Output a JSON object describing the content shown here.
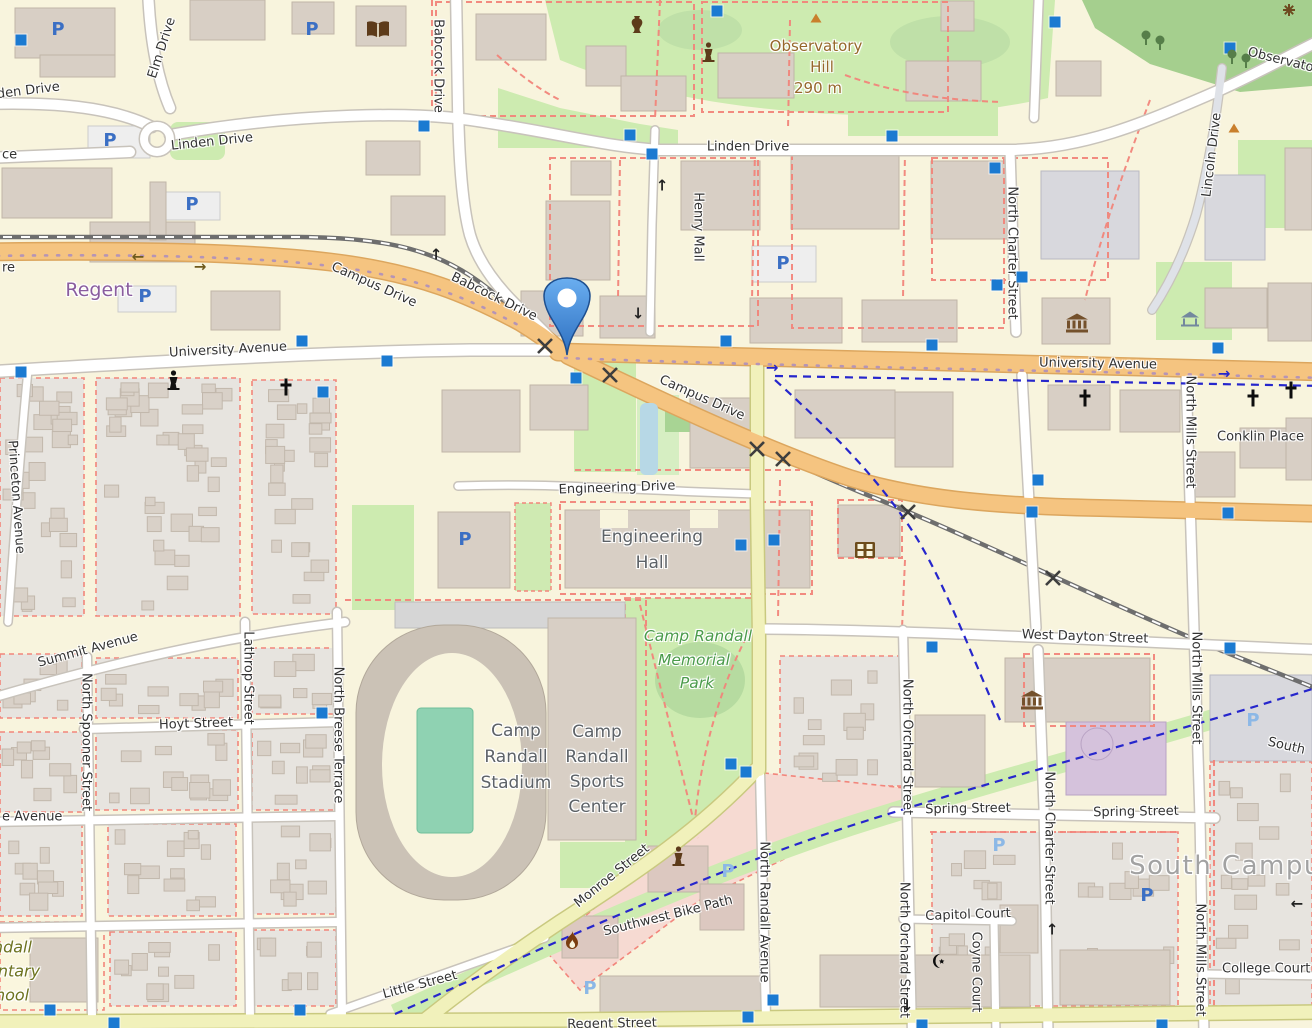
{
  "map": {
    "style": "openstreetmap-carto",
    "colors": {
      "campus_land": "#f8f4dd",
      "residential": "#e7e4df",
      "building": "#d8cfc5",
      "building_stroke": "#c0b5a8",
      "park_green": "#cdebb0",
      "wood_green": "#a5cf8e",
      "field_teal": "#8fd2b2",
      "road_orange": "#f5c480",
      "road_yellow": "#f1f1bb",
      "road_white": "#ffffff",
      "railway": "#6e6e6e",
      "footpath_red": "#f2857b",
      "cycleway_blue": "#2626cc",
      "parking_blue": "#3b6fc4",
      "parking_private": "#8cb8e6",
      "transit_square": "#1b7ad1",
      "water": "#b7d8e6",
      "pin_blue": "#3a7fd0",
      "retail_pink": "#f6dad2",
      "theatre_purple": "#d5c2dc"
    },
    "marker": {
      "x": 567,
      "y": 355,
      "shape": "teardrop-pin",
      "color": "#3a7fd0"
    },
    "labels": [
      {
        "t": "Elm Drive",
        "x": 162,
        "y": 48,
        "r": -72
      },
      {
        "t": "Linden Drive",
        "x": -22,
        "y": 97,
        "r": -7,
        "a": "start"
      },
      {
        "t": "Linden Drive",
        "x": 212,
        "y": 142,
        "r": -6
      },
      {
        "t": "Linden Drive",
        "x": 748,
        "y": 147,
        "r": 0
      },
      {
        "t": "Babcock Drive",
        "x": 438,
        "y": 66,
        "r": 90
      },
      {
        "t": "Babcock Drive",
        "x": 494,
        "y": 297,
        "r": 26
      },
      {
        "t": "Campus Drive",
        "x": 374,
        "y": 285,
        "r": 24
      },
      {
        "t": "Campus Drive",
        "x": 702,
        "y": 398,
        "r": 24
      },
      {
        "t": "Regent",
        "x": 99,
        "y": 290,
        "r": 0,
        "cls": "suburb"
      },
      {
        "t": "University Avenue",
        "x": 228,
        "y": 350,
        "r": -3
      },
      {
        "t": "University Avenue",
        "x": 1098,
        "y": 364,
        "r": 1
      },
      {
        "t": "Henry Mall",
        "x": 698,
        "y": 227,
        "r": 90
      },
      {
        "t": "Observatory",
        "x": 816,
        "y": 46,
        "r": 0,
        "cls": "peak"
      },
      {
        "t": "Hill",
        "x": 822,
        "y": 67,
        "r": 0,
        "cls": "peak"
      },
      {
        "t": "290 m",
        "x": 818,
        "y": 88,
        "r": 0,
        "cls": "peak"
      },
      {
        "t": "North Charter Street",
        "x": 1012,
        "y": 253,
        "r": 90
      },
      {
        "t": "Lincoln Drive",
        "x": 1212,
        "y": 155,
        "r": -83
      },
      {
        "t": "Observatory Drive",
        "x": 1248,
        "y": 52,
        "r": 14,
        "a": "start"
      },
      {
        "t": "Conklin Place",
        "x": 1217,
        "y": 437,
        "r": 0,
        "a": "start"
      },
      {
        "t": "Engineering Drive",
        "x": 617,
        "y": 488,
        "r": -2
      },
      {
        "t": "Engineering",
        "x": 652,
        "y": 537,
        "cls": "building"
      },
      {
        "t": "Hall",
        "x": 652,
        "y": 563,
        "cls": "building"
      },
      {
        "t": "Camp Randall",
        "x": 698,
        "y": 636,
        "cls": "park"
      },
      {
        "t": "Memorial",
        "x": 694,
        "y": 660,
        "cls": "park"
      },
      {
        "t": "Park",
        "x": 697,
        "y": 683,
        "cls": "park"
      },
      {
        "t": "Camp",
        "x": 516,
        "y": 731,
        "cls": "building"
      },
      {
        "t": "Randall",
        "x": 516,
        "y": 757,
        "cls": "building"
      },
      {
        "t": "Stadium",
        "x": 516,
        "y": 783,
        "cls": "building"
      },
      {
        "t": "Camp",
        "x": 597,
        "y": 732,
        "cls": "building"
      },
      {
        "t": "Randall",
        "x": 597,
        "y": 757,
        "cls": "building"
      },
      {
        "t": "Sports",
        "x": 597,
        "y": 782,
        "cls": "building"
      },
      {
        "t": "Center",
        "x": 597,
        "y": 807,
        "cls": "building"
      },
      {
        "t": "West Dayton Street",
        "x": 1085,
        "y": 637,
        "r": 2
      },
      {
        "t": "North Mills Street",
        "x": 1190,
        "y": 432,
        "r": 90
      },
      {
        "t": "North Mills Street",
        "x": 1196,
        "y": 688,
        "r": 90
      },
      {
        "t": "North Mills Street",
        "x": 1200,
        "y": 960,
        "r": 90
      },
      {
        "t": "North Breese Terrace",
        "x": 338,
        "y": 735,
        "r": 90
      },
      {
        "t": "Hoyt Street",
        "x": 196,
        "y": 724,
        "r": -2
      },
      {
        "t": "Lathrop Street",
        "x": 248,
        "y": 678,
        "r": 90
      },
      {
        "t": "North Spooner Street",
        "x": 86,
        "y": 742,
        "r": 90
      },
      {
        "t": "Summit Avenue",
        "x": 88,
        "y": 650,
        "r": -15
      },
      {
        "t": "e Avenue",
        "x": 2,
        "y": 817,
        "a": "start"
      },
      {
        "t": "Monroe Street",
        "x": 612,
        "y": 876,
        "r": -39
      },
      {
        "t": "Southwest Bike Path",
        "x": 668,
        "y": 916,
        "r": -14
      },
      {
        "t": "Little Street",
        "x": 420,
        "y": 985,
        "r": -15
      },
      {
        "t": "Regent Street",
        "x": 612,
        "y": 1024,
        "r": -1
      },
      {
        "t": "Spring Street",
        "x": 968,
        "y": 809,
        "r": -1
      },
      {
        "t": "Spring Street",
        "x": 1136,
        "y": 812,
        "r": -1
      },
      {
        "t": "Capitol Court",
        "x": 968,
        "y": 915,
        "r": -2
      },
      {
        "t": "Coyne Court",
        "x": 976,
        "y": 972,
        "r": 90
      },
      {
        "t": "North Orchard Street",
        "x": 907,
        "y": 747,
        "r": 90
      },
      {
        "t": "North Orchard Street",
        "x": 904,
        "y": 950,
        "r": 90
      },
      {
        "t": "North Randall Avenue",
        "x": 764,
        "y": 912,
        "r": 90
      },
      {
        "t": "North Charter Street",
        "x": 1049,
        "y": 838,
        "r": 90
      },
      {
        "t": "South Campus",
        "x": 1233,
        "y": 866,
        "cls": "district"
      },
      {
        "t": "College Court",
        "x": 1222,
        "y": 969,
        "a": "start"
      },
      {
        "t": "South",
        "x": 1268,
        "y": 742,
        "r": 13,
        "a": "start"
      },
      {
        "t": "Randall",
        "x": -28,
        "y": 947,
        "cls": "school",
        "a": "start"
      },
      {
        "t": "Elementary",
        "x": -52,
        "y": 971,
        "cls": "school",
        "a": "start"
      },
      {
        "t": "School",
        "x": -24,
        "y": 995,
        "cls": "school",
        "a": "start"
      },
      {
        "t": "Princeton Avenue",
        "x": 16,
        "y": 497,
        "r": 86
      },
      {
        "t": "ce",
        "x": 2,
        "y": 155,
        "a": "start"
      },
      {
        "t": "re",
        "x": 2,
        "y": 268,
        "a": "start"
      }
    ],
    "icons": [
      {
        "type": "parking",
        "x": 58,
        "y": 30
      },
      {
        "type": "parking",
        "x": 312,
        "y": 30
      },
      {
        "type": "parking",
        "x": 110,
        "y": 141
      },
      {
        "type": "parking",
        "x": 192,
        "y": 205
      },
      {
        "type": "parking",
        "x": 145,
        "y": 297
      },
      {
        "type": "parking",
        "x": 783,
        "y": 264
      },
      {
        "type": "parking",
        "x": 465,
        "y": 540
      },
      {
        "type": "parking",
        "x": 1147,
        "y": 896
      },
      {
        "type": "parking",
        "x": 728,
        "y": 872,
        "v": "light"
      },
      {
        "type": "parking",
        "x": 999,
        "y": 846,
        "v": "light"
      },
      {
        "type": "parking",
        "x": 1253,
        "y": 721,
        "v": "light"
      },
      {
        "type": "parking",
        "x": 590,
        "y": 989,
        "v": "light"
      },
      {
        "type": "bus",
        "x": 21,
        "y": 40
      },
      {
        "type": "bus",
        "x": 717,
        "y": 11
      },
      {
        "type": "bus",
        "x": 1055,
        "y": 22
      },
      {
        "type": "bus",
        "x": 1230,
        "y": 48
      },
      {
        "type": "bus",
        "x": 424,
        "y": 126
      },
      {
        "type": "bus",
        "x": 630,
        "y": 135
      },
      {
        "type": "bus",
        "x": 652,
        "y": 154
      },
      {
        "type": "bus",
        "x": 892,
        "y": 136
      },
      {
        "type": "bus",
        "x": 995,
        "y": 168
      },
      {
        "type": "bus",
        "x": 997,
        "y": 285
      },
      {
        "type": "bus",
        "x": 1022,
        "y": 277
      },
      {
        "type": "bus",
        "x": 21,
        "y": 372
      },
      {
        "type": "bus",
        "x": 302,
        "y": 341
      },
      {
        "type": "bus",
        "x": 387,
        "y": 361
      },
      {
        "type": "bus",
        "x": 323,
        "y": 392
      },
      {
        "type": "bus",
        "x": 576,
        "y": 378
      },
      {
        "type": "bus",
        "x": 726,
        "y": 341
      },
      {
        "type": "bus",
        "x": 741,
        "y": 545
      },
      {
        "type": "bus",
        "x": 774,
        "y": 540
      },
      {
        "type": "bus",
        "x": 932,
        "y": 345
      },
      {
        "type": "bus",
        "x": 1218,
        "y": 348
      },
      {
        "type": "bus",
        "x": 1038,
        "y": 480
      },
      {
        "type": "bus",
        "x": 1032,
        "y": 512
      },
      {
        "type": "bus",
        "x": 1228,
        "y": 513
      },
      {
        "type": "bus",
        "x": 731,
        "y": 764
      },
      {
        "type": "bus",
        "x": 746,
        "y": 772
      },
      {
        "type": "bus",
        "x": 322,
        "y": 713
      },
      {
        "type": "bus",
        "x": 50,
        "y": 1010
      },
      {
        "type": "bus",
        "x": 300,
        "y": 1010
      },
      {
        "type": "bus",
        "x": 114,
        "y": 1023
      },
      {
        "type": "bus",
        "x": 773,
        "y": 1000
      },
      {
        "type": "bus",
        "x": 748,
        "y": 1017
      },
      {
        "type": "bus",
        "x": 932,
        "y": 647
      },
      {
        "type": "bus",
        "x": 1230,
        "y": 648
      },
      {
        "type": "bus",
        "x": 922,
        "y": 1025
      },
      {
        "type": "bus",
        "x": 1162,
        "y": 1025
      },
      {
        "type": "church",
        "x": 286,
        "y": 387
      },
      {
        "type": "church",
        "x": 1085,
        "y": 398
      },
      {
        "type": "church",
        "x": 1253,
        "y": 398
      },
      {
        "type": "church",
        "x": 1291,
        "y": 390
      },
      {
        "type": "mosque",
        "x": 938,
        "y": 961
      },
      {
        "type": "museum",
        "x": 1077,
        "y": 323
      },
      {
        "type": "museum",
        "x": 1032,
        "y": 700
      },
      {
        "type": "library",
        "x": 378,
        "y": 30
      },
      {
        "type": "amphora",
        "x": 637,
        "y": 26
      },
      {
        "type": "statue",
        "x": 173,
        "y": 380,
        "v": "black"
      },
      {
        "type": "statue",
        "x": 708,
        "y": 52
      },
      {
        "type": "statue",
        "x": 678,
        "y": 856
      },
      {
        "type": "fire",
        "x": 572,
        "y": 940
      },
      {
        "type": "cinema",
        "x": 865,
        "y": 550
      },
      {
        "type": "peak",
        "x": 816,
        "y": 18
      },
      {
        "type": "peak",
        "x": 1234,
        "y": 128
      },
      {
        "type": "gazebo",
        "x": 1190,
        "y": 319
      },
      {
        "type": "flower",
        "x": 1289,
        "y": 10
      },
      {
        "type": "tree",
        "x": 1146,
        "y": 38
      },
      {
        "type": "tree",
        "x": 1160,
        "y": 43
      },
      {
        "type": "tree",
        "x": 1232,
        "y": 57
      },
      {
        "type": "tree",
        "x": 1246,
        "y": 61
      },
      {
        "type": "xing",
        "x": 545,
        "y": 346
      },
      {
        "type": "xing",
        "x": 610,
        "y": 375
      },
      {
        "type": "xing",
        "x": 757,
        "y": 449
      },
      {
        "type": "xing",
        "x": 783,
        "y": 459
      },
      {
        "type": "xing",
        "x": 908,
        "y": 512
      },
      {
        "type": "xing",
        "x": 1053,
        "y": 578
      },
      {
        "type": "arrow-up",
        "x": 662,
        "y": 186
      },
      {
        "type": "arrow-up",
        "x": 436,
        "y": 255
      },
      {
        "type": "arrow-up",
        "x": 1052,
        "y": 930
      },
      {
        "type": "arrow-down",
        "x": 638,
        "y": 314
      },
      {
        "type": "arrow-down",
        "x": 907,
        "y": 1006
      },
      {
        "type": "arrow-left",
        "x": 138,
        "y": 257,
        "v": "brown"
      },
      {
        "type": "arrow-right",
        "x": 200,
        "y": 267,
        "v": "brown"
      },
      {
        "type": "arrow-right",
        "x": 772,
        "y": 368,
        "v": "blue"
      },
      {
        "type": "arrow-right",
        "x": 1224,
        "y": 374,
        "v": "blue"
      },
      {
        "type": "arrow-left",
        "x": 1297,
        "y": 904
      }
    ]
  }
}
